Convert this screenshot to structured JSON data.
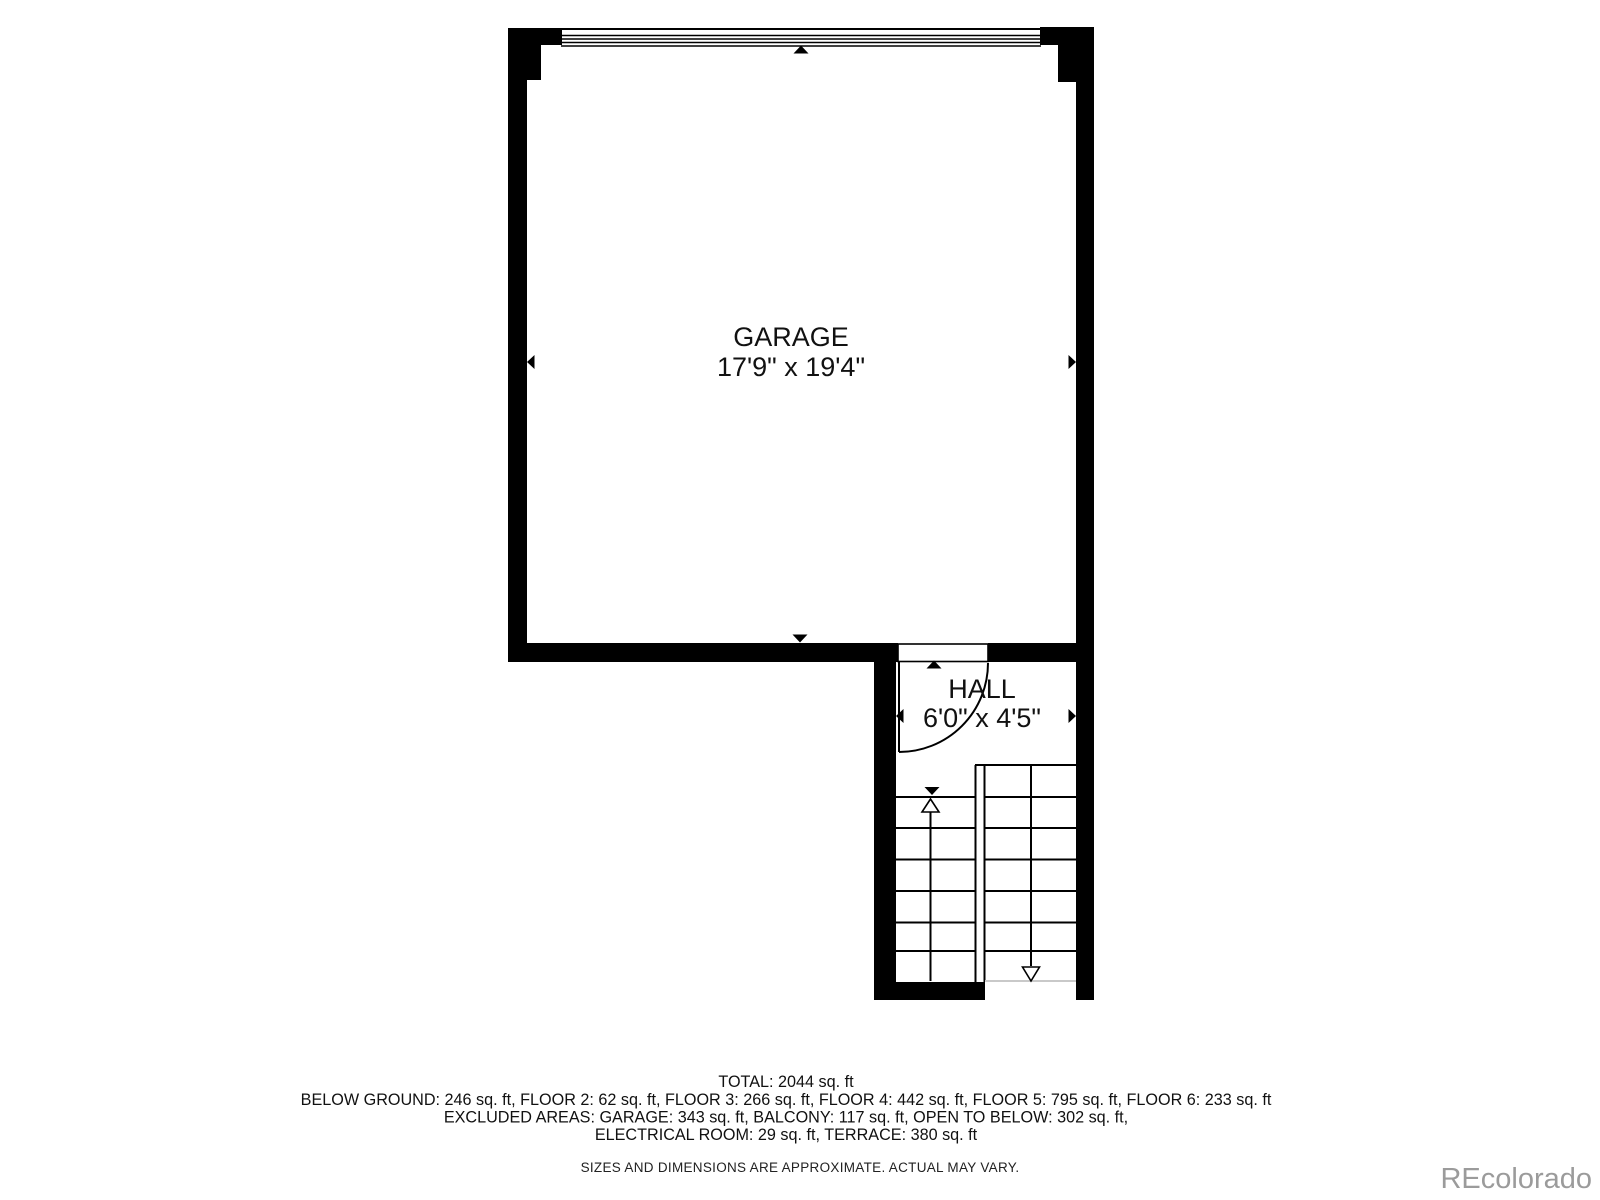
{
  "floor_plan": {
    "garage": {
      "name": "GARAGE",
      "dimensions": "17'9\" x 19'4\""
    },
    "hall": {
      "name": "HALL",
      "dimensions": "6'0\" x 4'5\""
    }
  },
  "summary": {
    "total": "TOTAL: 2044 sq. ft",
    "floors": "BELOW GROUND: 246 sq. ft, FLOOR 2: 62 sq. ft, FLOOR 3: 266 sq. ft, FLOOR 4: 442 sq. ft, FLOOR 5: 795 sq. ft, FLOOR 6: 233 sq. ft",
    "excluded_line1": "EXCLUDED AREAS: GARAGE: 343 sq. ft, BALCONY: 117 sq. ft, OPEN TO BELOW: 302 sq. ft,",
    "excluded_line2": "ELECTRICAL ROOM: 29 sq. ft, TERRACE: 380 sq. ft",
    "disclaimer": "SIZES AND DIMENSIONS ARE APPROXIMATE. ACTUAL MAY VARY."
  },
  "watermark": {
    "text": "REcolorado"
  },
  "colors": {
    "wall": "#000000",
    "background": "#ffffff",
    "watermark_gray": "#9b9b9b",
    "stair_open_edge": "#c9c9c9"
  }
}
